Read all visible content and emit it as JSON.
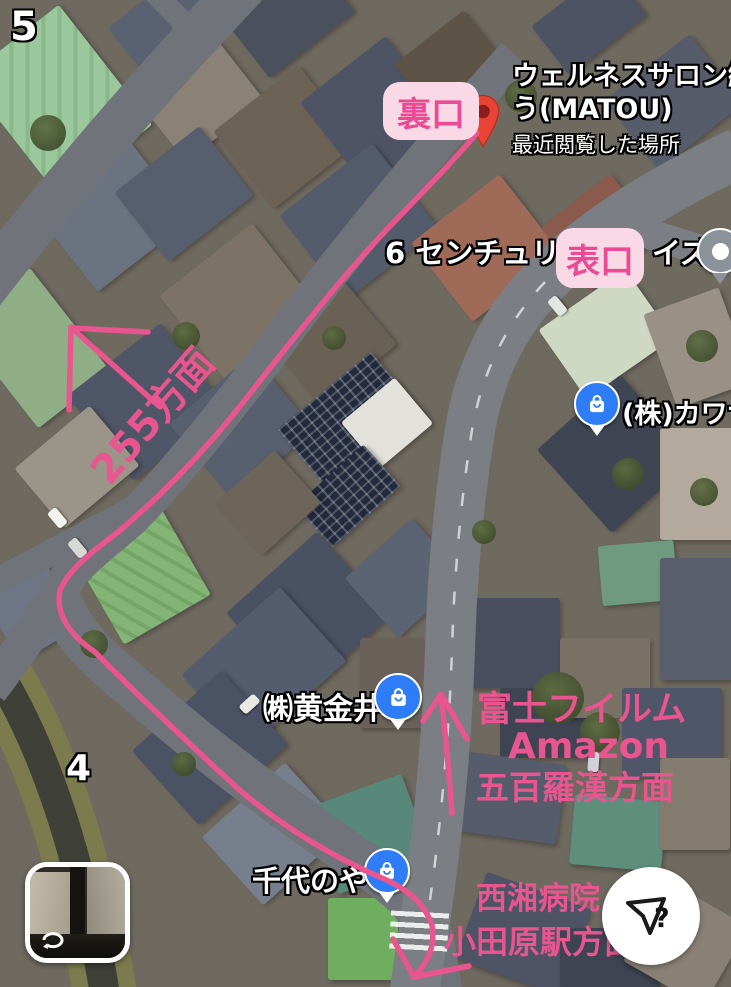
{
  "theme": {
    "pink": "#e8558f",
    "label_bg": "#f9d9e6",
    "label_text": "#ea4b94",
    "pin_red": "#e94335",
    "pin_red_dot": "#8c1d18",
    "pin_blue": "#2e7cf6",
    "pin_gray": "#8c9299"
  },
  "markers": {
    "wellness": {
      "line1": "ウェルネスサロン纏",
      "line2": "う(MATOU)",
      "note": "最近閲覧した場所",
      "icon": "red-pin"
    },
    "century": {
      "number": "6",
      "name_left": "センチュリー",
      "name_right": "イズ",
      "icon": "gray-dot-pin"
    },
    "kawa": {
      "name": "(株)カワサ",
      "icon": "blue-shopping-bag-pin"
    },
    "koganei": {
      "name": "㈱黄金井",
      "icon": "blue-shopping-bag-pin"
    },
    "chiyonoya": {
      "name": "千代のや",
      "icon": "blue-shopping-bag-pin"
    }
  },
  "street_numbers": {
    "n5": "5",
    "n4": "4"
  },
  "annotations": {
    "back_entrance": "裏口",
    "front_entrance": "表口",
    "route255": "255方面",
    "fujifilm": "富士フイルム",
    "amazon": "Amazon",
    "gohyakurakan": "五百羅漢方面",
    "seisho_hospital": "西湘病院",
    "odawara_station": "小田原駅方面"
  },
  "controls": {
    "compass_question": "?"
  }
}
